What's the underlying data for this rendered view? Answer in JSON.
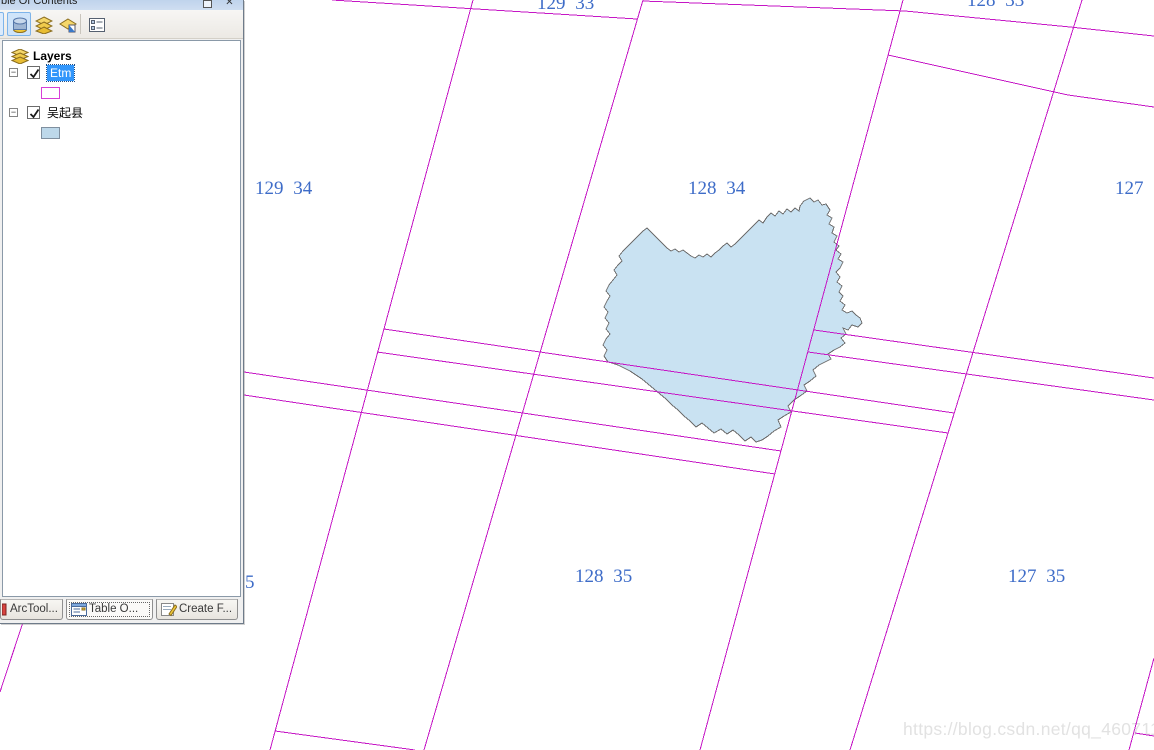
{
  "window": {
    "title_visible": "ble Of Contents"
  },
  "toc": {
    "toolbar_icons": [
      "list-by-drawing-order",
      "list-by-source",
      "list-by-visibility",
      "options"
    ],
    "titlebar_icons": [
      "restore-icon",
      "close-icon"
    ],
    "close_glyph": "✕",
    "expander_glyph": "−",
    "root_label": "Layers",
    "layers": [
      {
        "name": "Etm",
        "checked": true,
        "selected": true,
        "symbol_type": "magenta-outline"
      },
      {
        "name": "吴起县",
        "checked": true,
        "selected": false,
        "symbol_type": "lightblue-fill"
      }
    ],
    "tabs": [
      {
        "label": "ArcTool...",
        "active": false,
        "icon": "arctoolbox-icon"
      },
      {
        "label": "Table O...",
        "active": true,
        "icon": "table-of-contents-icon"
      },
      {
        "label": "Create F...",
        "active": false,
        "icon": "create-features-icon"
      }
    ]
  },
  "map": {
    "scene_labels": [
      {
        "text": "129 33"
      },
      {
        "text": "128 33"
      },
      {
        "text": "129 34"
      },
      {
        "text": "128 34"
      },
      {
        "text": "127"
      },
      {
        "text": "128 35"
      },
      {
        "text": "127 35"
      },
      {
        "text": "5"
      }
    ],
    "colors": {
      "grid": "#c516c5",
      "label": "#3e6cc8",
      "county_fill": "#c9e2f2",
      "county_stroke": "#6f6f6f"
    }
  },
  "watermark": {
    "text": "https://blog.csdn.net/qq_46071133"
  }
}
